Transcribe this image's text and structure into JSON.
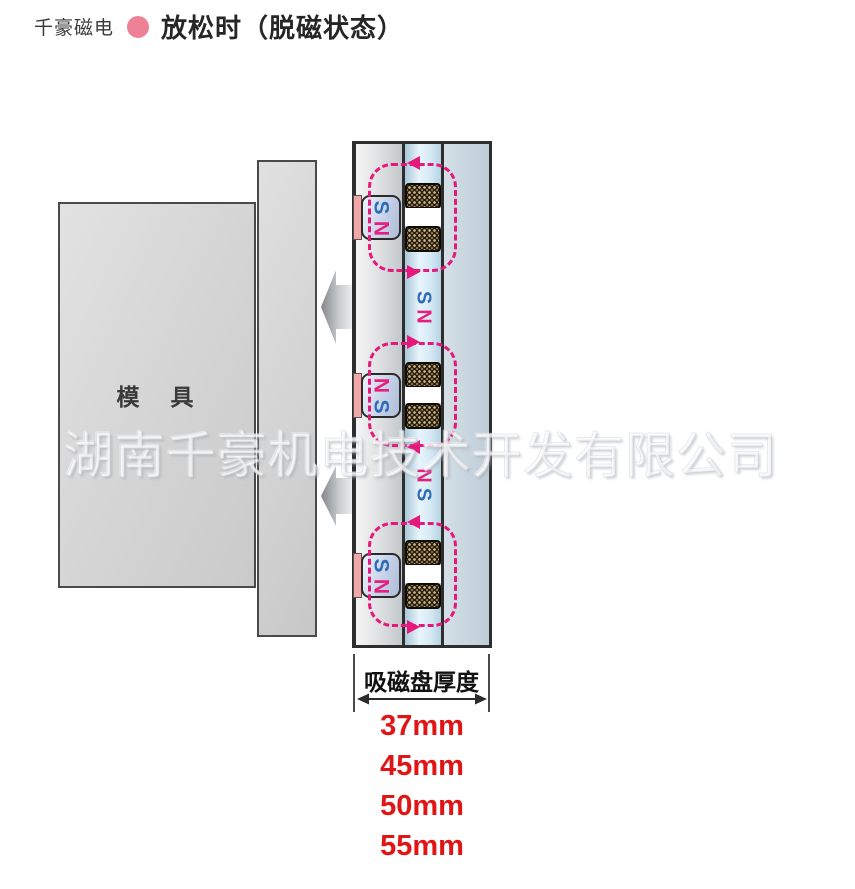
{
  "header": {
    "brand": "千豪磁电",
    "title": "放松时（脱磁状态）",
    "bullet_color": "#ee8196"
  },
  "watermark": "湖南千豪机电技术开发有限公司",
  "diagram": {
    "mold_label": "模　具",
    "units": [
      {
        "pole_top": "S",
        "pole_bottom": "N",
        "top_arrow": "left",
        "bottom_arrow": "right"
      },
      {
        "pole_top": "N",
        "pole_bottom": "S",
        "top_arrow": "right",
        "bottom_arrow": "left"
      },
      {
        "pole_top": "S",
        "pole_bottom": "N",
        "top_arrow": "left",
        "bottom_arrow": "right"
      }
    ],
    "gap_labels": [
      {
        "top": "S",
        "bottom": "N"
      },
      {
        "top": "N",
        "bottom": "S"
      }
    ],
    "colors": {
      "flux_loop": "#e6187c",
      "north": "#e61f7e",
      "south": "#2e6cb8",
      "magnet_pad": "#f2a6a6"
    }
  },
  "dimension": {
    "label": "吸磁盘厚度",
    "values": [
      "37mm",
      "45mm",
      "50mm",
      "55mm"
    ],
    "value_color": "#e01616"
  }
}
